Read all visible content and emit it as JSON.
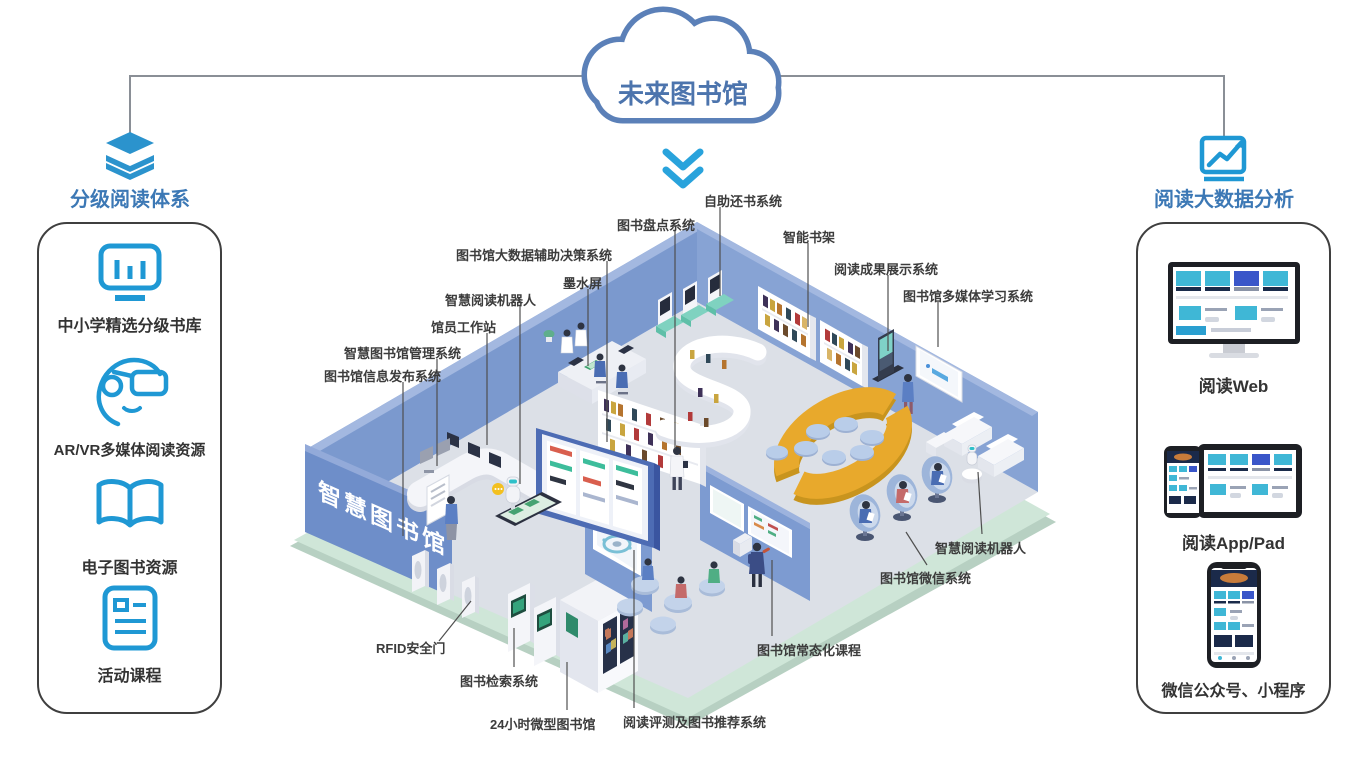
{
  "cloud": {
    "title": "未来图书馆"
  },
  "left_panel": {
    "title": "分级阅读体系",
    "items": [
      {
        "icon": "bar-chart-monitor-icon",
        "label": "中小学精选分级书库"
      },
      {
        "icon": "vr-headset-icon",
        "label": "AR/VR多媒体阅读资源"
      },
      {
        "icon": "open-book-icon",
        "label": "电子图书资源"
      },
      {
        "icon": "activity-document-icon",
        "label": "活动课程"
      }
    ]
  },
  "right_panel": {
    "title": "阅读大数据分析",
    "items": [
      {
        "icon": "desktop-monitor-graphic",
        "label": "阅读Web"
      },
      {
        "icon": "phone-tablet-graphic",
        "label": "阅读App/Pad"
      },
      {
        "icon": "smartphone-graphic",
        "label": "微信公众号、小程序"
      }
    ]
  },
  "scene": {
    "wall_title": "智慧图书馆",
    "callouts": [
      {
        "label": "自助还书系统"
      },
      {
        "label": "图书盘点系统"
      },
      {
        "label": "智能书架"
      },
      {
        "label": "阅读成果展示系统"
      },
      {
        "label": "图书馆多媒体学习系统"
      },
      {
        "label": "图书馆大数据辅助决策系统"
      },
      {
        "label": "墨水屏"
      },
      {
        "label": "智慧阅读机器人"
      },
      {
        "label": "馆员工作站"
      },
      {
        "label": "智慧图书馆管理系统"
      },
      {
        "label": "图书馆信息发布系统"
      },
      {
        "label": "RFID安全门"
      },
      {
        "label": "图书检索系统"
      },
      {
        "label": "24小时微型图书馆"
      },
      {
        "label": "阅读评测及图书推荐系统"
      },
      {
        "label": "图书馆常态化课程"
      },
      {
        "label": "图书馆微信系统"
      },
      {
        "label": "智慧阅读机器人"
      }
    ]
  },
  "colors": {
    "accent_blue": "#1f98d4",
    "header_blue": "#3c78b5",
    "cloud_blue": "#5b80b8",
    "chevron_blue": "#29a3dc",
    "wall_blue": "#7b99ce",
    "floor_gray": "#dce0e7",
    "base_green": "#cfe6d8",
    "donut_yellow": "#e8a92c",
    "label_dark": "#3c3c3c"
  }
}
